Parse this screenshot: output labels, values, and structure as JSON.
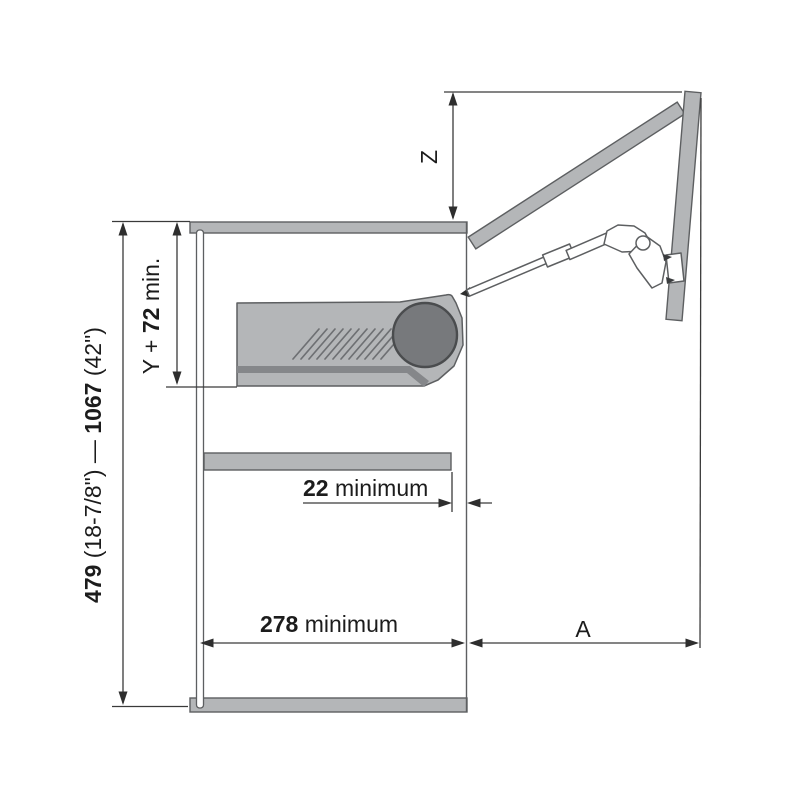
{
  "diagram_labels": {
    "height": {
      "min_value": "479",
      "min_note": " (18-7/8\") — ",
      "max_value": "1067",
      "max_note": " (42\")"
    },
    "inner_height": {
      "pre": "Y + ",
      "value": "72",
      "post": " min."
    },
    "z": "Z",
    "shelf_gap": {
      "value": "22",
      "unit": " minimum"
    },
    "depth": {
      "value": "278",
      "unit": " minimum"
    },
    "front": "A"
  },
  "colors": {
    "panel-fill": "#b4b6b8",
    "stripe-fill": "#85878a",
    "drum-fill": "#77797c",
    "outline": "#5d5f61",
    "outline-dark": "#4a4c4e",
    "dim-line": "#3a3a3a",
    "text-color": "#1c1c1c",
    "bg": "#ffffff"
  }
}
